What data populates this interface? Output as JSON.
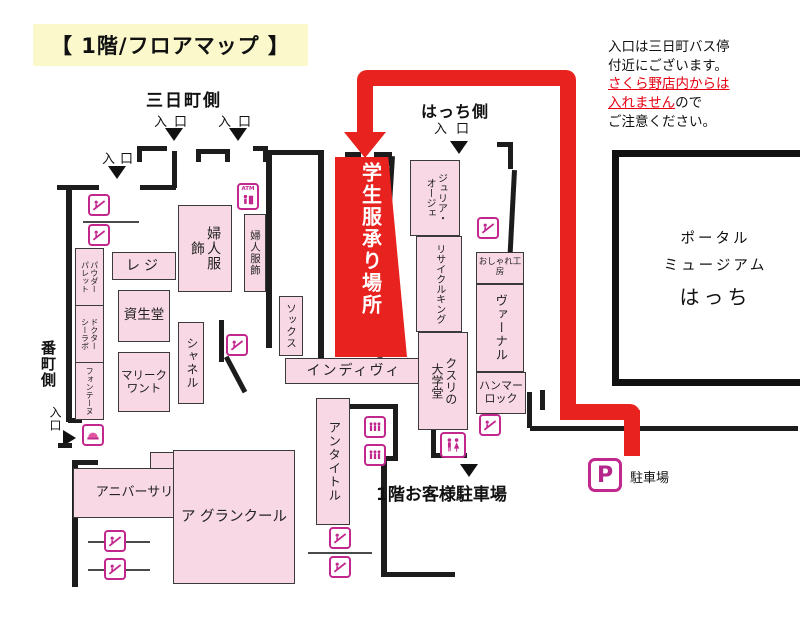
{
  "title": "【 1階/フロアマップ 】",
  "note": {
    "line1": "入口は三日町バス停",
    "line2": "付近にございます。",
    "red1": "さくら野店内からは",
    "red2": "入れません",
    "suffix": "ので",
    "line3": "ご注意ください。"
  },
  "labels": {
    "sannichi_side": "三日町側",
    "hacchi_side": "はっち側",
    "bancho_side": "番町側",
    "entrance": "入口",
    "parking_1f": "1階お客様駐車場"
  },
  "hacchi_building": {
    "line1": "ポータル",
    "line2": "ミュージアム",
    "line3": "はっち"
  },
  "highlight": {
    "label": "学生服承り場所",
    "color": "#e8231f"
  },
  "areas": [
    {
      "id": "fujin-fukushoku-main",
      "label": "婦人服飾"
    },
    {
      "id": "fujin-fukushoku-annex",
      "label": "婦人服飾"
    },
    {
      "id": "reji",
      "label": "レジ"
    },
    {
      "id": "shiseido",
      "label": "資生堂"
    },
    {
      "id": "mary-quant",
      "label": "マリークワント"
    },
    {
      "id": "chanel",
      "label": "シャネル"
    },
    {
      "id": "powder-palette",
      "label": "パウダーパレット"
    },
    {
      "id": "dr-ci-labo",
      "label": "ドクターシーラボ"
    },
    {
      "id": "fontaine",
      "label": "フォンテーヌ"
    },
    {
      "id": "socks",
      "label": "ソックス"
    },
    {
      "id": "indivi",
      "label": "インディヴィ"
    },
    {
      "id": "julia-oge",
      "label": "ジュリア・オージェ"
    },
    {
      "id": "recycle-king",
      "label": "リサイクルキング"
    },
    {
      "id": "kusuri-no-daigakudo",
      "label": "クスリの大学堂"
    },
    {
      "id": "oshare-kobo",
      "label": "おしゃれ工房"
    },
    {
      "id": "vernal",
      "label": "ヴァーナル"
    },
    {
      "id": "hammer-lock",
      "label": "ハンマーロック"
    },
    {
      "id": "untitled",
      "label": "アンタイトル"
    },
    {
      "id": "anniversary",
      "label": "アニバーサリー"
    },
    {
      "id": "a-grand-cool",
      "label": "ア グランクール"
    }
  ],
  "parking": {
    "symbol": "P",
    "label": "駐車場"
  },
  "icons": {
    "escalator": "escalator-icon",
    "elevator": "elevator-icon",
    "restroom": "restroom-icon",
    "atm": "atm-icon",
    "service": "service-counter-icon",
    "parking": "parking-icon"
  },
  "colors": {
    "highlight_red": "#e8231f",
    "area_pink": "#f8d8e4",
    "icon_magenta": "#c2278d",
    "title_yellow": "#fbf8cc",
    "note_red": "#e60012"
  }
}
